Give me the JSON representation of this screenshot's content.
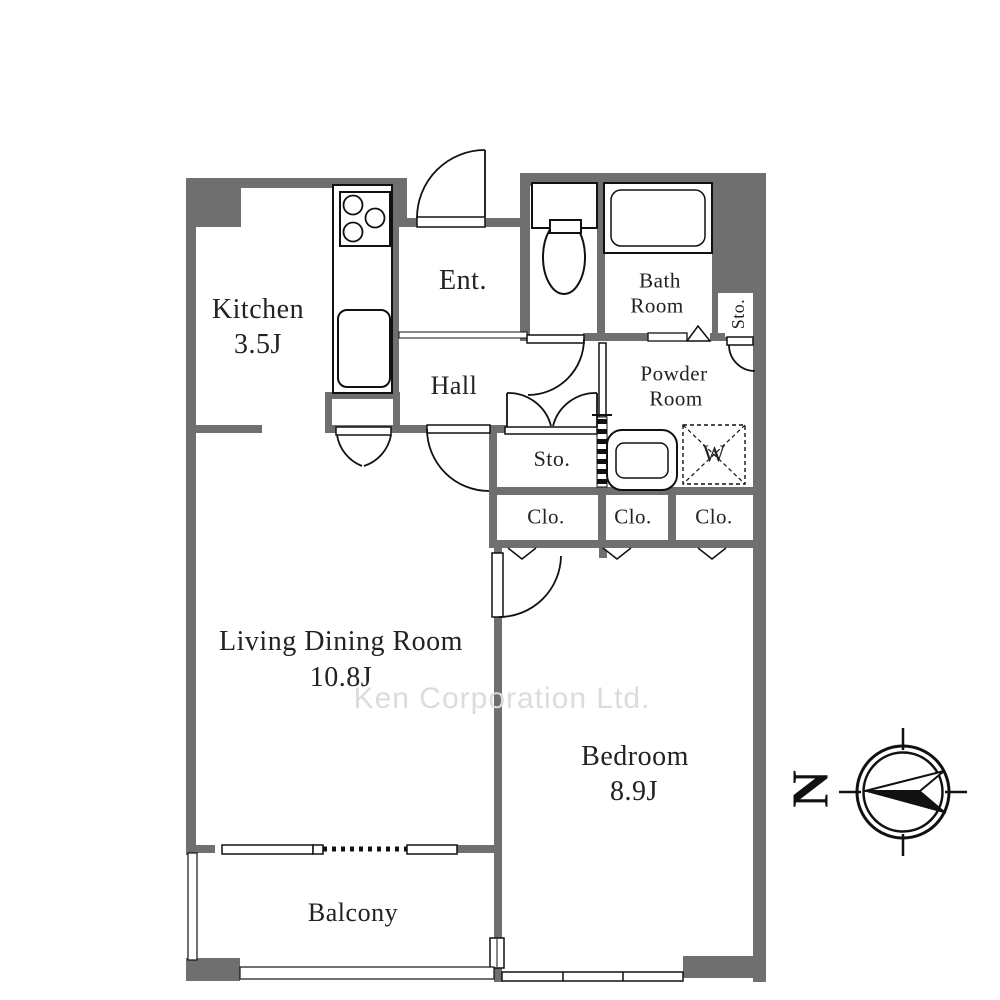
{
  "floorplan": {
    "rooms": {
      "kitchen": {
        "name": "Kitchen",
        "area": "3.5J"
      },
      "entrance": {
        "name": "Ent."
      },
      "hall": {
        "name": "Hall"
      },
      "bathroom": {
        "line1": "Bath",
        "line2": "Room"
      },
      "powder": {
        "line1": "Powder",
        "line2": "Room"
      },
      "storage_upper": {
        "name": "Sto."
      },
      "storage_hall": {
        "name": "Sto."
      },
      "closets": [
        "Clo.",
        "Clo.",
        "Clo."
      ],
      "living": {
        "name": "Living Dining Room",
        "area": "10.8J"
      },
      "bedroom": {
        "name": "Bedroom",
        "area": "8.9J"
      },
      "balcony": {
        "name": "Balcony"
      }
    },
    "fixtures": {
      "washing_machine_label": "W"
    },
    "compass": {
      "north": "N"
    },
    "watermark": {
      "text": "Ken Corporation Ltd."
    },
    "colors": {
      "wall": "#6f6f6f",
      "line": "#111111",
      "text": "#222222",
      "watermark": "#dcdcdc"
    }
  }
}
